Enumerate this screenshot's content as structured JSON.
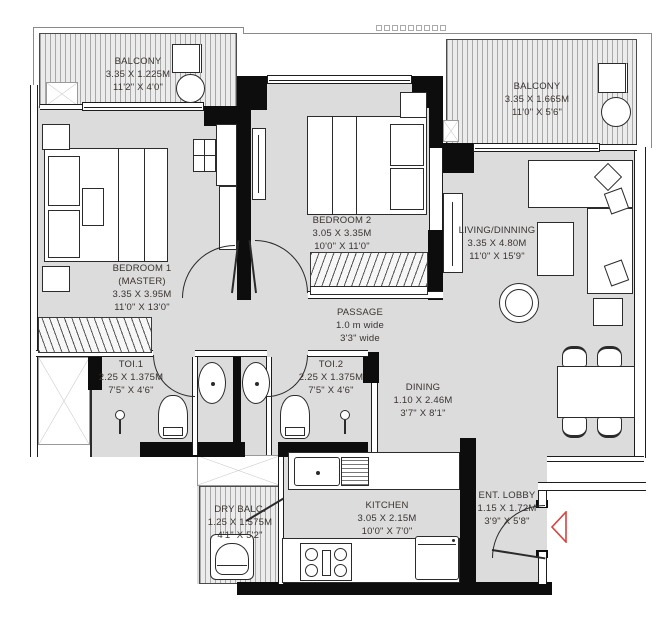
{
  "plan_title": "2 BHK Floor Plan",
  "rooms": {
    "balcony_left": {
      "name": "BALCONY",
      "dim_m": "3.35 X 1.225M",
      "dim_ft": "11'2\" X 4'0\""
    },
    "bedroom1": {
      "name": "BEDROOM 1",
      "sub": "(MASTER)",
      "dim_m": "3.35 X 3.95M",
      "dim_ft": "11'0\" X 13'0\""
    },
    "bedroom2": {
      "name": "BEDROOM 2",
      "dim_m": "3.05 X 3.35M",
      "dim_ft": "10'0\" X 11'0\""
    },
    "balcony_right": {
      "name": "BALCONY",
      "dim_m": "3.35 X 1.665M",
      "dim_ft": "11'0\" X 5'6\""
    },
    "living_dining": {
      "name": "LIVING/DINNING",
      "dim_m": "3.35 X 4.80M",
      "dim_ft": "11'0\" X 15'9\""
    },
    "passage": {
      "name": "PASSAGE",
      "dim_m": "1.0 m wide",
      "dim_ft": "3'3\" wide"
    },
    "toilet1": {
      "name": "TOI.1",
      "dim_m": "2.25 X 1.375M",
      "dim_ft": "7'5\" X 4'6\""
    },
    "toilet2": {
      "name": "TOI.2",
      "dim_m": "2.25 X 1.375M",
      "dim_ft": "7'5\" X 4'6\""
    },
    "dining": {
      "name": "DINING",
      "dim_m": "1.10 X 2.46M",
      "dim_ft": "3'7\" X 8'1\""
    },
    "kitchen": {
      "name": "KITCHEN",
      "dim_m": "3.05 X 2.15M",
      "dim_ft": "10'0\" X 7'0\""
    },
    "dry_balcony": {
      "name": "DRY BALC.",
      "dim_m": "1.25 X 1.575M",
      "dim_ft": "4'1\" X 5'2\""
    },
    "entrance_lobby": {
      "name": "ENT. LOBBY",
      "dim_m": "1.15 X 1.72M",
      "dim_ft": "3'9\" X 5'8\""
    }
  },
  "colors": {
    "floor": "#dcdcdc",
    "wall": "#0d0d0d",
    "entry_arrow": "#d9413d",
    "text": "#3a332e"
  }
}
